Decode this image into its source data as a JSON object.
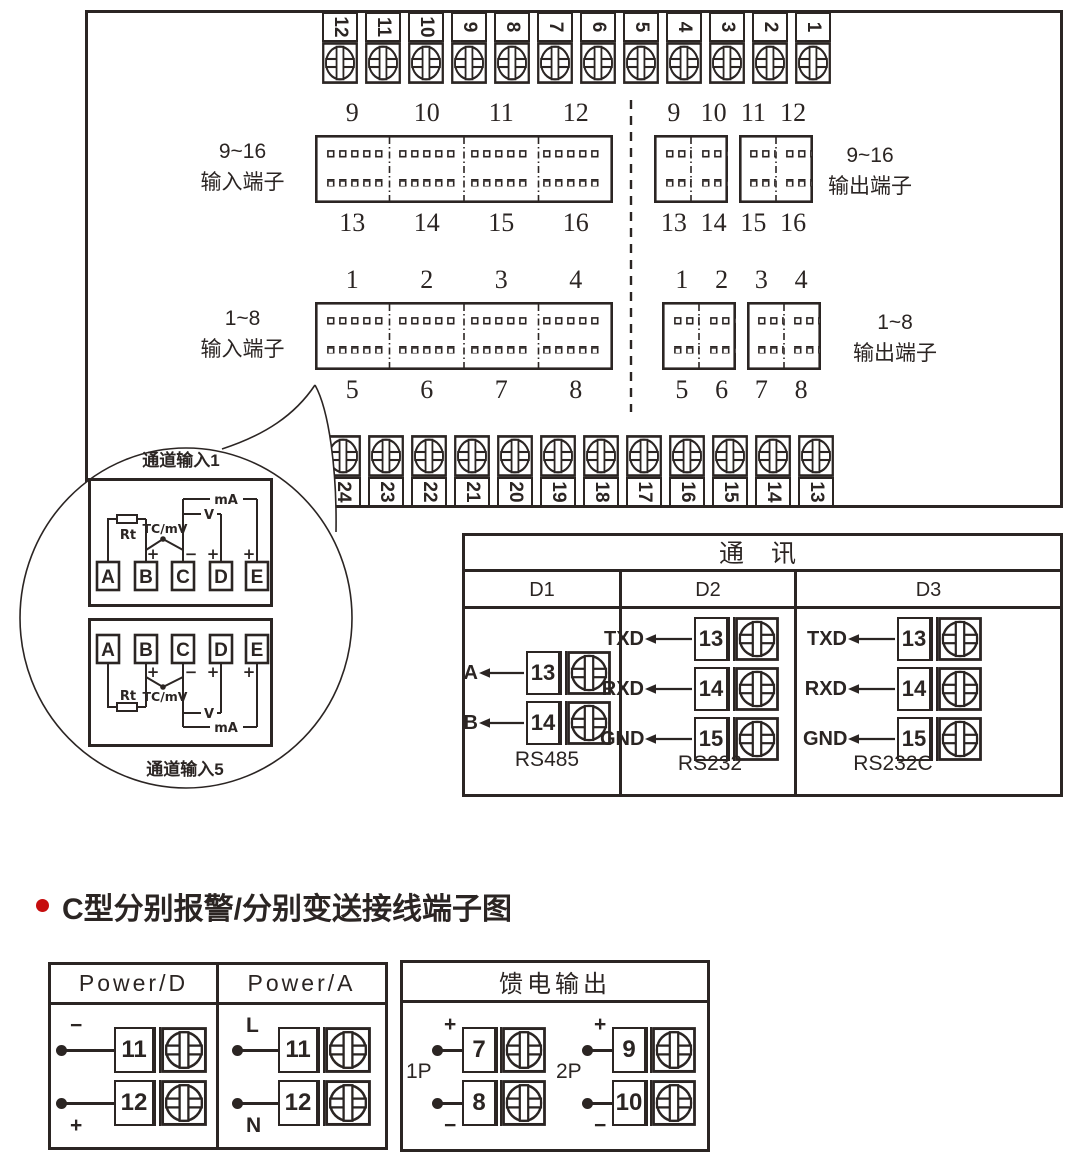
{
  "main_panel": {
    "top_strip": [
      "12",
      "11",
      "10",
      "9",
      "8",
      "7",
      "6",
      "5",
      "4",
      "3",
      "2",
      "1"
    ],
    "bottom_strip": [
      "24",
      "23",
      "22",
      "21",
      "20",
      "19",
      "18",
      "17",
      "16",
      "15",
      "14",
      "13"
    ],
    "r916": {
      "left1": "9~16",
      "left2": "输入端子",
      "right1": "9~16",
      "right2": "输出端子",
      "in_top": [
        "9",
        "10",
        "11",
        "12"
      ],
      "in_bottom": [
        "13",
        "14",
        "15",
        "16"
      ],
      "out_top": [
        "9",
        "10",
        "11",
        "12"
      ],
      "out_bottom": [
        "13",
        "14",
        "15",
        "16"
      ]
    },
    "r18": {
      "left1": "1~8",
      "left2": "输入端子",
      "right1": "1~8",
      "right2": "输出端子",
      "in_top": [
        "1",
        "2",
        "3",
        "4"
      ],
      "in_bottom": [
        "5",
        "6",
        "7",
        "8"
      ],
      "out_top": [
        "1",
        "2",
        "3",
        "4"
      ],
      "out_bottom": [
        "5",
        "6",
        "7",
        "8"
      ]
    }
  },
  "balloon": {
    "ch1": "通道输入1",
    "ch5": "通道输入5",
    "terminals": [
      "A",
      "B",
      "C",
      "D",
      "E"
    ],
    "rt": "Rt",
    "tc": "TC/mV",
    "v": "V",
    "ma": "mA",
    "plus": "+",
    "minus": "−"
  },
  "comm": {
    "title": "通 讯",
    "cols": [
      {
        "name": "D1",
        "rows": [
          {
            "label": "A",
            "num": "13"
          },
          {
            "label": "B",
            "num": "14"
          }
        ],
        "footer": "RS485"
      },
      {
        "name": "D2",
        "rows": [
          {
            "label": "TXD",
            "num": "13"
          },
          {
            "label": "RXD",
            "num": "14"
          },
          {
            "label": "GND",
            "num": "15"
          }
        ],
        "footer": "RS232"
      },
      {
        "name": "D3",
        "rows": [
          {
            "label": "TXD",
            "num": "13"
          },
          {
            "label": "RXD",
            "num": "14"
          },
          {
            "label": "GND",
            "num": "15"
          }
        ],
        "footer": "RS232C"
      }
    ]
  },
  "section_title": "C型分别报警/分别变送接线端子图",
  "colors": {
    "ink": "#2b2523",
    "bullet_red": "#c60d0e"
  },
  "power": {
    "headers": [
      "Power/D",
      "Power/A"
    ],
    "d_rows": [
      {
        "sign": "−",
        "num": "11"
      },
      {
        "sign": "+",
        "num": "12"
      }
    ],
    "a_rows": [
      {
        "sign": "L",
        "num": "11"
      },
      {
        "sign": "N",
        "num": "12"
      }
    ]
  },
  "feed": {
    "title": "馈电输出",
    "groups": [
      {
        "name": "1P",
        "rows": [
          {
            "sign": "+",
            "num": "7"
          },
          {
            "sign": "−",
            "num": "8"
          }
        ]
      },
      {
        "name": "2P",
        "rows": [
          {
            "sign": "+",
            "num": "9"
          },
          {
            "sign": "−",
            "num": "10"
          }
        ]
      }
    ]
  }
}
